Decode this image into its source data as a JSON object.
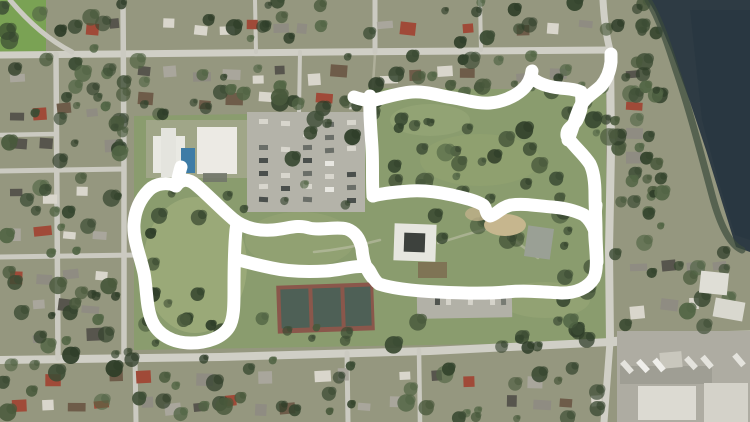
{
  "meta": {
    "type": "satellite-aerial-map",
    "description": "Aerial satellite photo of a suburban neighborhood with a large park; a white hand-drawn marker traces a walking route loop through the park",
    "width": 750,
    "height": 422
  },
  "render": {
    "seed": 1337
  },
  "palette": {
    "residential_base": "#95977f",
    "road": "#cbcac1",
    "road_major": "#d0cfc6",
    "park_green": "#8a9c6e",
    "grass_field": "#7aa254",
    "lake_water": "#2e3b44",
    "lake_deep": "#273640",
    "shore_vegetation": "#3c4b3c",
    "annotation_white": "#ffffff",
    "house_colors": [
      "#d9d6cc",
      "#a9a69c",
      "#8f8c82",
      "#a04a38",
      "#6e5c49",
      "#57554d"
    ],
    "tree_greens": [
      "#3c4c34",
      "#35452e",
      "#49593c",
      "#2f3e29",
      "#526545"
    ],
    "path_faint": "#cfcdbd"
  },
  "map": {
    "grass_field": {
      "x": 0,
      "y": 0,
      "w": 46,
      "h": 58
    },
    "park": {
      "points": "134,116 368,112 368,88 606,90 606,342 134,350"
    },
    "park_patches": [
      [
        195,
        265,
        52,
        68,
        "#9fad7c",
        0.75
      ],
      [
        300,
        240,
        55,
        28,
        "#96a574",
        0.6
      ],
      [
        480,
        160,
        60,
        26,
        "#93a36f",
        0.5
      ],
      [
        545,
        300,
        45,
        18,
        "#9aa878",
        0.5
      ],
      [
        430,
        120,
        40,
        16,
        "#9aa97a",
        0.5
      ]
    ],
    "roads": [
      {
        "name": "top-street",
        "d": "M0,55 L330,52 L610,50",
        "w": 7
      },
      {
        "name": "north-bend",
        "d": "M610,50 C606,35 604,18 603,0",
        "w": 7
      },
      {
        "name": "east-road",
        "d": "M610,50 L611,150 L609,250 L610,342",
        "w": 8
      },
      {
        "name": "south-street",
        "d": "M0,360 L220,357 L430,351 L610,342",
        "w": 8
      },
      {
        "name": "south-street-east",
        "d": "M610,342 C650,338 700,336 750,335",
        "w": 9
      },
      {
        "name": "east-road-south",
        "d": "M610,342 L604,422",
        "w": 7
      },
      {
        "name": "west-road-1",
        "d": "M56,54 L58,358",
        "w": 5.5
      },
      {
        "name": "west-road-2",
        "d": "M123,0 L124,170 L124,358",
        "w": 5.5
      },
      {
        "name": "left-cross-1",
        "d": "M0,135 L56,134",
        "w": 4.5
      },
      {
        "name": "left-cross-2",
        "d": "M0,171 L124,169",
        "w": 5
      },
      {
        "name": "left-cross-3",
        "d": "M0,257 L140,255",
        "w": 5
      },
      {
        "name": "nw-diagonal",
        "d": "M10,0 C25,18 45,38 72,52",
        "w": 5
      },
      {
        "name": "top-vertical-1",
        "d": "M375,0 L375,52",
        "w": 5
      },
      {
        "name": "top-vertical-2",
        "d": "M255,0 L256,52",
        "w": 4
      },
      {
        "name": "top-vertical-3",
        "d": "M480,0 L481,50",
        "w": 4
      },
      {
        "name": "bottom-vertical-1",
        "d": "M135,356 L136,422",
        "w": 5
      },
      {
        "name": "bottom-vertical-2",
        "d": "M347,353 L348,422",
        "w": 5
      },
      {
        "name": "bottom-vertical-3",
        "d": "M419,350 L420,422",
        "w": 4.5
      },
      {
        "name": "park-entrance",
        "d": "M300,52 L299,112",
        "w": 4
      }
    ],
    "park_paths": [
      "M375,54 C374,70 373,84 372,96",
      "M380,240 C358,246 336,250 314,252",
      "M438,243 C456,238 472,232 492,228",
      "M507,236 C520,244 530,252 538,258"
    ],
    "house_blocks": [
      {
        "x": 48,
        "y": 4,
        "w": 560,
        "h": 44
      },
      {
        "x": 614,
        "y": 4,
        "w": 36,
        "h": 44
      },
      {
        "x": 2,
        "y": 62,
        "w": 116,
        "h": 100
      },
      {
        "x": 2,
        "y": 176,
        "w": 116,
        "h": 74
      },
      {
        "x": 2,
        "y": 263,
        "w": 116,
        "h": 88
      },
      {
        "x": 130,
        "y": 62,
        "w": 236,
        "h": 52
      },
      {
        "x": 372,
        "y": 60,
        "w": 236,
        "h": 32
      },
      {
        "x": 4,
        "y": 366,
        "w": 606,
        "h": 52
      },
      {
        "x": 618,
        "y": 58,
        "w": 32,
        "h": 145
      },
      {
        "x": 622,
        "y": 252,
        "w": 126,
        "h": 74
      }
    ],
    "tree_zones": [
      {
        "x": 0,
        "y": 0,
        "w": 745,
        "h": 50,
        "n": 40
      },
      {
        "x": 0,
        "y": 52,
        "w": 128,
        "h": 305,
        "n": 60
      },
      {
        "x": 128,
        "y": 55,
        "w": 250,
        "h": 62,
        "n": 26
      },
      {
        "x": 375,
        "y": 55,
        "w": 235,
        "h": 38,
        "n": 20
      },
      {
        "x": 0,
        "y": 358,
        "w": 615,
        "h": 62,
        "n": 46
      },
      {
        "x": 612,
        "y": 55,
        "w": 48,
        "h": 275,
        "n": 22
      },
      {
        "x": 385,
        "y": 118,
        "w": 180,
        "h": 100,
        "n": 30
      },
      {
        "x": 440,
        "y": 218,
        "w": 80,
        "h": 50,
        "n": 8
      },
      {
        "x": 148,
        "y": 192,
        "w": 115,
        "h": 145,
        "n": 12
      },
      {
        "x": 140,
        "y": 318,
        "w": 470,
        "h": 30,
        "n": 24
      },
      {
        "x": 556,
        "y": 96,
        "w": 58,
        "h": 245,
        "n": 16
      },
      {
        "x": 245,
        "y": 112,
        "w": 120,
        "h": 100,
        "n": 8
      },
      {
        "x": 660,
        "y": 250,
        "w": 90,
        "h": 80,
        "n": 10
      },
      {
        "x": 636,
        "y": 6,
        "w": 30,
        "h": 230,
        "n": 16,
        "late": 1
      }
    ],
    "lake": {
      "points": "648,0 750,0 750,252 736,247 722,202 706,150 690,102 671,50 655,12",
      "deep_points": "690,10 750,10 750,240 735,235 718,180 702,120",
      "shore_d": "M648,0 C660,20 668,45 676,70 C688,105 700,150 712,195 C720,225 730,245 742,250"
    },
    "ground_features": [
      {
        "shape": "rect",
        "name": "building-apron",
        "x": 146,
        "y": 120,
        "w": 102,
        "h": 58,
        "fill": "#b2ae9f",
        "op": 0.55
      },
      {
        "shape": "rect",
        "name": "parking-lot-main",
        "x": 247,
        "y": 112,
        "w": 118,
        "h": 100,
        "fill": "#b4b3a9"
      },
      {
        "shape": "row",
        "name": "parked-cars-row-1",
        "x": 259,
        "y": 119,
        "dx": 0,
        "dy": 13,
        "n": 7,
        "w": 9,
        "h": 5,
        "rot": 0,
        "colors": [
          "#4a4f4c",
          "#e8e7e1",
          "#6a6e68",
          "#d8d6cd"
        ]
      },
      {
        "shape": "row",
        "name": "parked-cars-row-2",
        "x": 281,
        "y": 121,
        "dx": 0,
        "dy": 13,
        "n": 7,
        "w": 9,
        "h": 5,
        "rot": 0,
        "colors": [
          "#e8e7e1",
          "#4a4f4c",
          "#d8d6cd",
          "#6a6e68"
        ]
      },
      {
        "shape": "row",
        "name": "parked-cars-row-3",
        "x": 303,
        "y": 119,
        "dx": 0,
        "dy": 13,
        "n": 7,
        "w": 9,
        "h": 5,
        "rot": 0,
        "colors": [
          "#6a6e68",
          "#d8d6cd",
          "#4a4f4c",
          "#e8e7e1"
        ]
      },
      {
        "shape": "row",
        "name": "parked-cars-row-4",
        "x": 325,
        "y": 122,
        "dx": 0,
        "dy": 13,
        "n": 6,
        "w": 9,
        "h": 5,
        "rot": 0,
        "colors": [
          "#d8d6cd",
          "#6a6e68",
          "#e8e7e1",
          "#4a4f4c"
        ]
      },
      {
        "shape": "row",
        "name": "parked-cars-row-5",
        "x": 347,
        "y": 120,
        "dx": 0,
        "dy": 13,
        "n": 7,
        "w": 9,
        "h": 5,
        "rot": 0,
        "colors": [
          "#4a4f4c",
          "#d8d6cd",
          "#6a6e68",
          "#e8e7e1"
        ]
      },
      {
        "shape": "rect",
        "name": "parking-lot-se",
        "x": 417,
        "y": 291,
        "w": 95,
        "h": 27,
        "fill": "#b2b1a7",
        "rot": -1
      },
      {
        "shape": "row",
        "name": "parked-cars-se",
        "x": 424,
        "y": 296,
        "dx": 11,
        "dy": 0,
        "n": 8,
        "w": 5,
        "h": 9,
        "rot": 0,
        "colors": [
          "#50544f",
          "#e6e5df",
          "#777b73",
          "#d5d3ca"
        ]
      },
      {
        "shape": "rect",
        "name": "tennis-courts-outer",
        "x": 277,
        "y": 284,
        "w": 97,
        "h": 48,
        "fill": "#8a574b",
        "rot": -2
      },
      {
        "shape": "rect",
        "name": "tennis-court-1",
        "x": 281,
        "y": 289,
        "w": 28,
        "h": 39,
        "fill": "#4e6056",
        "rot": -2
      },
      {
        "shape": "rect",
        "name": "tennis-court-2",
        "x": 313,
        "y": 288,
        "w": 28,
        "h": 39,
        "fill": "#4e6056",
        "rot": -2
      },
      {
        "shape": "rect",
        "name": "tennis-court-3",
        "x": 345,
        "y": 287,
        "w": 26,
        "h": 39,
        "fill": "#4e6056",
        "rot": -2
      },
      {
        "shape": "rect",
        "name": "industrial-yard",
        "x": 617,
        "y": 331,
        "w": 133,
        "h": 91,
        "fill": "#aeaca2"
      },
      {
        "shape": "rect",
        "name": "industrial-shadow",
        "x": 620,
        "y": 366,
        "w": 92,
        "h": 18,
        "fill": "#8f8d83",
        "op": 0.45
      }
    ],
    "structures": [
      {
        "shape": "rect",
        "name": "community-building-west",
        "x": 153,
        "y": 136,
        "w": 32,
        "h": 37,
        "fill": "#e9e9e3"
      },
      {
        "shape": "rect",
        "name": "community-building-west-wing",
        "x": 161,
        "y": 128,
        "w": 15,
        "h": 49,
        "fill": "#e4e4de"
      },
      {
        "shape": "rect",
        "name": "community-building-east",
        "x": 197,
        "y": 127,
        "w": 40,
        "h": 47,
        "fill": "#eceae4"
      },
      {
        "shape": "rect",
        "name": "swimming-pool",
        "x": 181,
        "y": 148,
        "w": 14,
        "h": 25,
        "fill": "#3e7ca6"
      },
      {
        "shape": "rect",
        "name": "building-awning",
        "x": 203,
        "y": 173,
        "w": 24,
        "h": 9,
        "fill": "#70746a",
        "op": 0.85
      },
      {
        "shape": "rect",
        "name": "pavilion-roof",
        "x": 394,
        "y": 224,
        "w": 42,
        "h": 37,
        "fill": "#e6e6df",
        "rot": 2
      },
      {
        "shape": "rect",
        "name": "pavilion-core",
        "x": 404,
        "y": 233,
        "w": 21,
        "h": 19,
        "fill": "#3d413d",
        "rot": 2
      },
      {
        "shape": "rect",
        "name": "picnic-structure",
        "x": 418,
        "y": 262,
        "w": 29,
        "h": 16,
        "fill": "#7d7052",
        "op": 0.9
      },
      {
        "shape": "ellipse",
        "name": "playground-sand",
        "x": 505,
        "y": 225,
        "w": 21,
        "h": 11,
        "fill": "#c6b68e"
      },
      {
        "shape": "ellipse",
        "name": "playground-sand-2",
        "x": 477,
        "y": 214,
        "w": 12,
        "h": 7,
        "fill": "#bfb089",
        "op": 0.8
      },
      {
        "shape": "rect",
        "name": "park-shelter",
        "x": 526,
        "y": 227,
        "w": 26,
        "h": 31,
        "fill": "#9aa095",
        "rot": 8
      },
      {
        "shape": "rect",
        "name": "house-white-1",
        "x": 700,
        "y": 272,
        "w": 28,
        "h": 22,
        "fill": "#dfded6",
        "rot": 6
      },
      {
        "shape": "rect",
        "name": "house-white-2",
        "x": 714,
        "y": 300,
        "w": 30,
        "h": 19,
        "fill": "#d9d8cf",
        "rot": 10
      },
      {
        "shape": "rect",
        "name": "warehouse-1",
        "x": 638,
        "y": 386,
        "w": 58,
        "h": 34,
        "fill": "#dcdad2"
      },
      {
        "shape": "rect",
        "name": "warehouse-2",
        "x": 704,
        "y": 383,
        "w": 44,
        "h": 39,
        "fill": "#d4d2c9"
      },
      {
        "shape": "rect",
        "name": "warehouse-3",
        "x": 660,
        "y": 352,
        "w": 22,
        "h": 16,
        "fill": "#c9c7bd",
        "rot": -5
      },
      {
        "shape": "row",
        "name": "truck-trailers",
        "x": 624,
        "y": 360,
        "dx": 16,
        "dy": -1,
        "n": 8,
        "w": 6,
        "h": 14,
        "rot": -40,
        "colors": [
          "#efeeea",
          "#e4e3dd"
        ]
      }
    ]
  },
  "annotation": {
    "color": "#ffffff",
    "stroke_width": 13,
    "strokes": [
      {
        "name": "route-left-loop",
        "d": "M181,167 C179,173 178,180 176,186 C168,182 156,183 149,190 C141,198 135,209 134,224 C133,240 140,255 144,273 C147,289 146,307 152,321 C158,335 173,343 191,343 C207,343 222,338 229,327 C234,319 234,305 234,291 C234,271 234,250 236,230 L237,223"
      },
      {
        "name": "route-left-ridge",
        "d": "M176,186 C182,178 189,179 196,185 C207,194 220,208 233,219 C245,229 259,231 273,230 C287,229 297,224 309,228 C321,231 335,226 347,229 C355,232 360,239 362,249 C363,261 366,269 372,277"
      },
      {
        "name": "route-south-path",
        "d": "M235,259 C246,262 258,265 272,268 C290,272 308,272 326,271 C342,270 354,265 366,267 C371,270 372,279 379,284 C394,289 416,291 438,292 C460,293 484,294 506,292 C524,290 543,292 562,293 C576,293 588,288 594,278 C598,268 596,253 595,239 C594,227 595,215 596,205"
      },
      {
        "name": "route-west-link",
        "d": "M370,96 C369,112 371,130 372,148 C373,164 372,181 373,196"
      },
      {
        "name": "route-north-path",
        "d": "M354,97 C362,100 368,101 375,100 C387,97 399,93 412,92 C426,91 440,96 454,98 C466,100 478,104 490,103 C502,102 514,97 522,90 C528,85 531,79 532,71"
      },
      {
        "name": "route-north-path-2",
        "d": "M532,78 C539,84 549,87 560,88 C568,89 575,89 581,92"
      },
      {
        "name": "route-east-path",
        "d": "M581,92 C583,102 581,112 577,120 C573,127 566,128 567,136 C572,145 583,153 590,164 C594,172 595,183 595,195 C595,207 596,219 596,231 C596,243 597,253 597,262"
      },
      {
        "name": "route-middle-path",
        "d": "M373,196 C384,193 396,192 410,191 C424,190 438,192 452,195 C464,198 475,200 483,205 C487,208 485,214 490,216 C496,215 501,207 511,205 C524,203 538,206 552,207 C564,208 576,211 584,215 C589,219 592,224 594,229"
      },
      {
        "name": "route-north-spur",
        "d": "M568,140 C573,129 575,117 580,107 C585,97 595,92 601,86 C607,79 610,71 611,62 L611,54"
      }
    ]
  }
}
